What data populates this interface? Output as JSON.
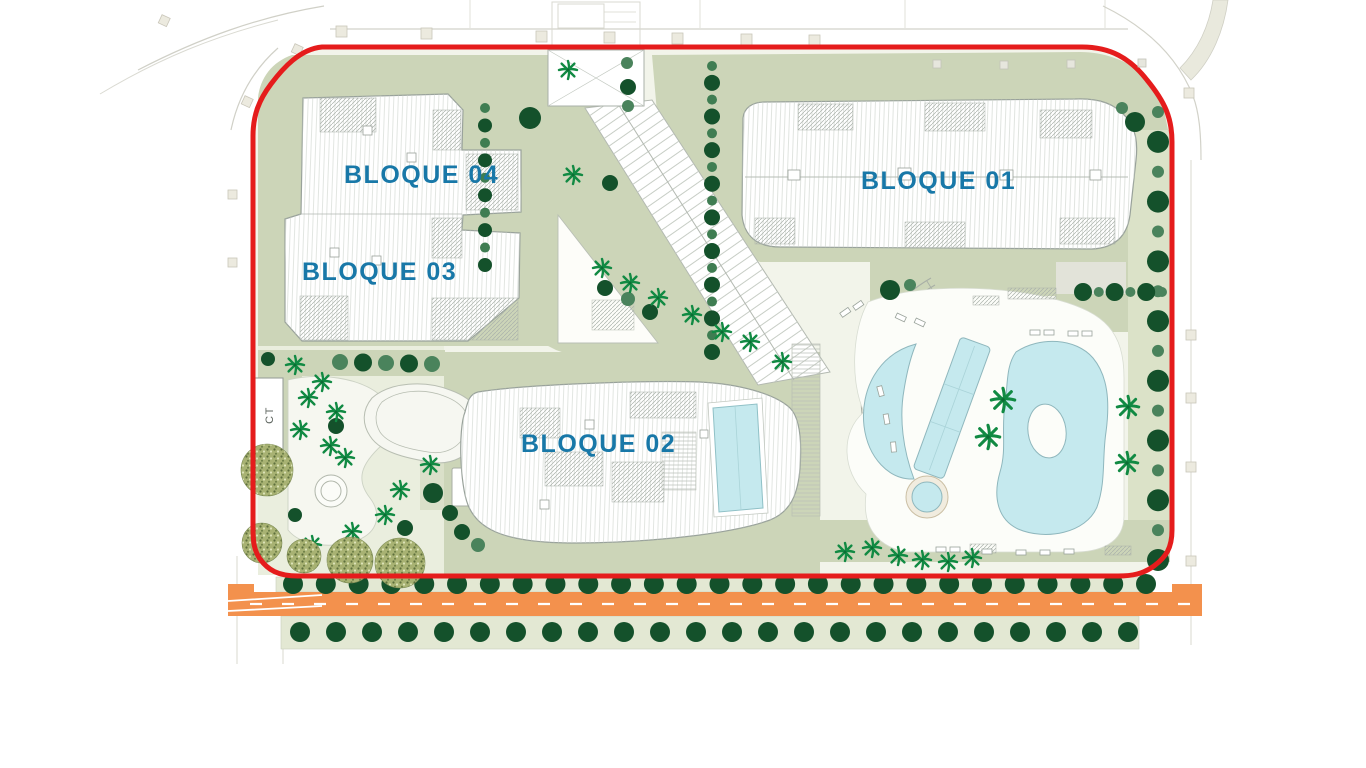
{
  "labels": {
    "bloque01": "BLOQUE 01",
    "bloque02": "BLOQUE 02",
    "bloque03": "BLOQUE 03",
    "bloque04": "BLOQUE 04",
    "ct": "CT"
  },
  "colors": {
    "label_teal": "#1878a8",
    "boundary_red": "#e51c1c",
    "road_orange": "#f3914d",
    "pool_cyan": "#c5e9ee",
    "landscape_sage": "#ccd5b8",
    "landscape_pale": "#e3e8d3",
    "tree_dark_green": "#14512b",
    "tree_mid_green": "#4a835c",
    "palm_green": "#118a43"
  },
  "icons": {
    "tree": "round-canopy-circle",
    "palm": "palm-tree-star",
    "olive": "stippled-canopy-circle",
    "pool": "organic-cyan-shape"
  }
}
